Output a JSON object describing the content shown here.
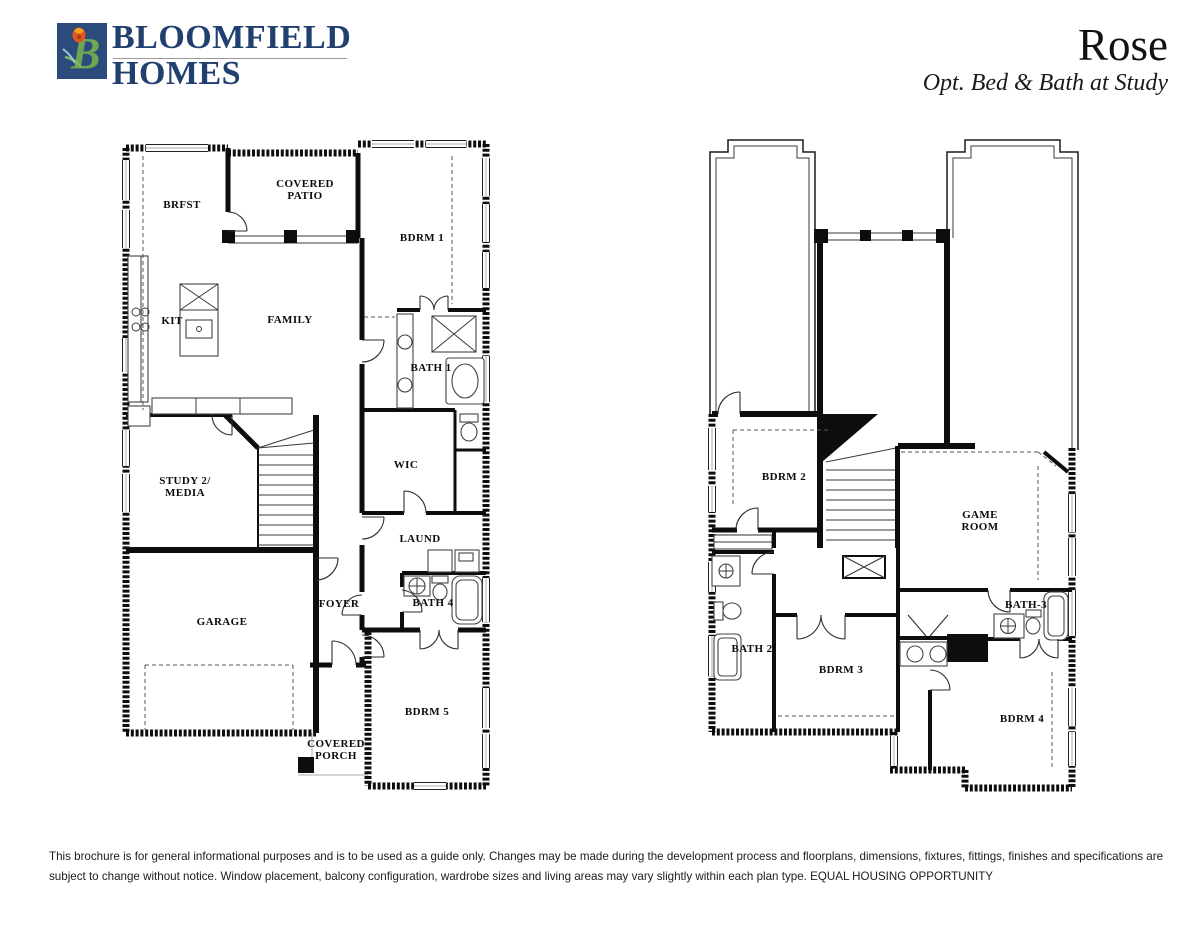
{
  "header": {
    "logo": {
      "icon": "bloomfield-tulip-b-monogram",
      "monogram": "B",
      "square_color": "#2c4b7d",
      "b_color": "#6fa653",
      "flower_color": "#e2571d",
      "name_line1": "BLOOMFIELD",
      "name_line2": "HOMES",
      "name_color": "#21406f"
    },
    "plan_name": "Rose",
    "plan_option": "Opt. Bed & Bath at Study"
  },
  "first_floor": {
    "rooms": {
      "brfst": "BRFST",
      "covered_patio": "COVERED PATIO",
      "bdrm1": "BDRM 1",
      "kit": "KIT",
      "family": "FAMILY",
      "bath1": "BATH 1",
      "wic": "WIC",
      "study": "STUDY 2/ MEDIA",
      "laund": "LAUND",
      "foyer": "FOYER",
      "bath4": "BATH 4",
      "garage": "GARAGE",
      "bdrm5": "BDRM 5",
      "covered_porch": "COVERED PORCH"
    }
  },
  "second_floor": {
    "rooms": {
      "bdrm2": "BDRM 2",
      "game_room": "GAME ROOM",
      "bath2": "BATH 2",
      "bdrm3": "BDRM 3",
      "bath3": "BATH-3",
      "bdrm4": "BDRM 4"
    }
  },
  "footer": {
    "disclaimer_line1": "This brochure is for general informational purposes and is to be used as a guide only. Changes may be made during the development process and floorplans, dimensions, fixtures, fittings, finishes and specifications are",
    "disclaimer_line2": "subject to change without notice. Window placement, balcony configuration, wardrobe sizes and living areas may vary slightly within each plan type.  EQUAL HOUSING OPPORTUNITY"
  }
}
